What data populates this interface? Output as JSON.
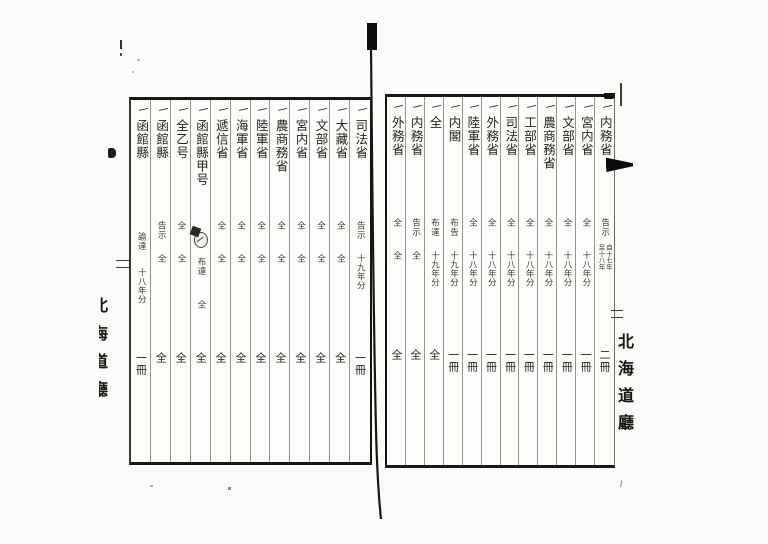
{
  "scan": {
    "description": "Scanned two-page spread of a handwritten Japanese archival ledger (vertical script, right-to-left)",
    "ink_color": "#26241d",
    "rule_line_color": "#97958a",
    "frame_color": "#191814"
  },
  "right_margin_title": "北海道廳",
  "left_margin_title_partial": "北海道廳",
  "right_page": {
    "reading_order": "right-to-left",
    "columns": [
      {
        "tally": "一",
        "name": "内務省",
        "note": "告示",
        "year": "自十七年/至十八年",
        "count": "二冊"
      },
      {
        "tally": "一",
        "name": "宮内省",
        "note": "全",
        "year": "十八年分",
        "count": "一冊"
      },
      {
        "tally": "一",
        "name": "文部省",
        "note": "全",
        "year": "十八年分",
        "count": "一冊"
      },
      {
        "tally": "一",
        "name": "農商務省",
        "note": "全",
        "year": "十八年分",
        "count": "一冊"
      },
      {
        "tally": "一",
        "name": "工部省",
        "note": "全",
        "year": "十八年分",
        "count": "一冊"
      },
      {
        "tally": "一",
        "name": "司法省",
        "note": "全",
        "year": "十八年分",
        "count": "一冊"
      },
      {
        "tally": "一",
        "name": "外務省",
        "note": "全",
        "year": "十八年分",
        "count": "一冊"
      },
      {
        "tally": "一",
        "name": "陸軍省",
        "note": "全",
        "year": "十八年分",
        "count": "一冊"
      },
      {
        "tally": "一",
        "name": "内閣",
        "note": "布告",
        "year": "十九年分",
        "count": "一冊"
      },
      {
        "tally": "一",
        "name": "全",
        "note": "布達",
        "year": "十九年分",
        "count": "全"
      },
      {
        "tally": "一",
        "name": "内務省",
        "note": "告示",
        "year": "全",
        "count": "全"
      },
      {
        "tally": "一",
        "name": "外務省",
        "note": "全",
        "year": "全",
        "count": "全"
      }
    ]
  },
  "left_page": {
    "reading_order": "right-to-left",
    "columns": [
      {
        "tally": "一",
        "name": "司法省",
        "note": "告示",
        "year": "十九年分",
        "count": "一冊"
      },
      {
        "tally": "一",
        "name": "大藏省",
        "note": "全",
        "year": "全",
        "count": "全"
      },
      {
        "tally": "一",
        "name": "文部省",
        "note": "全",
        "year": "全",
        "count": "全"
      },
      {
        "tally": "一",
        "name": "宮内省",
        "note": "全",
        "year": "全",
        "count": "全"
      },
      {
        "tally": "一",
        "name": "農商務省",
        "note": "全",
        "year": "全",
        "count": "全"
      },
      {
        "tally": "一",
        "name": "陸軍省",
        "note": "全",
        "year": "全",
        "count": "全"
      },
      {
        "tally": "一",
        "name": "海軍省",
        "note": "全",
        "year": "全",
        "count": "全"
      },
      {
        "tally": "一",
        "name": "遞信省",
        "note": "全",
        "year": "全",
        "count": "全"
      },
      {
        "tally": "一",
        "name": "函館縣甲号",
        "seal": "◯",
        "note": "布達",
        "year": "全",
        "count": "全"
      },
      {
        "tally": "一",
        "name": "全乙号",
        "note": "全",
        "year": "全",
        "count": "全"
      },
      {
        "tally": "一",
        "name": "函館縣",
        "note": "告示",
        "year": "全",
        "count": "全"
      },
      {
        "tally": "一",
        "name": "函館縣",
        "note": "諭達",
        "year": "十八年分",
        "count": "一冊"
      }
    ]
  }
}
